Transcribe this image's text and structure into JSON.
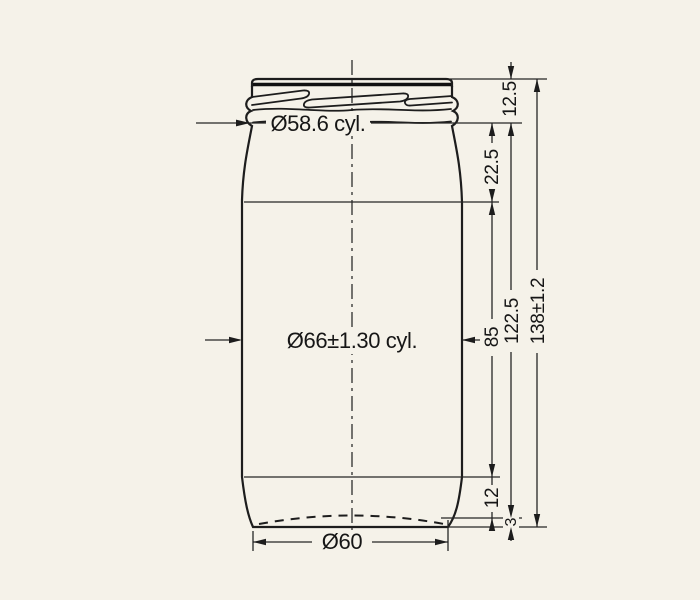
{
  "colors": {
    "paper": "#f5f2e9",
    "ink": "#1d1d1d"
  },
  "drawing": {
    "type": "technical-drawing",
    "dimensions": {
      "neck_diameter": "Ø58.6 cyl.",
      "body_diameter": "Ø66±1.30 cyl.",
      "base_diameter": "Ø60",
      "finish_height": "12.5",
      "shoulder_height": "22.5",
      "body_height": "85",
      "neck_to_base_height": "122.5",
      "overall_height": "138±1.2",
      "heel_height": "12",
      "base_height": "3"
    }
  }
}
